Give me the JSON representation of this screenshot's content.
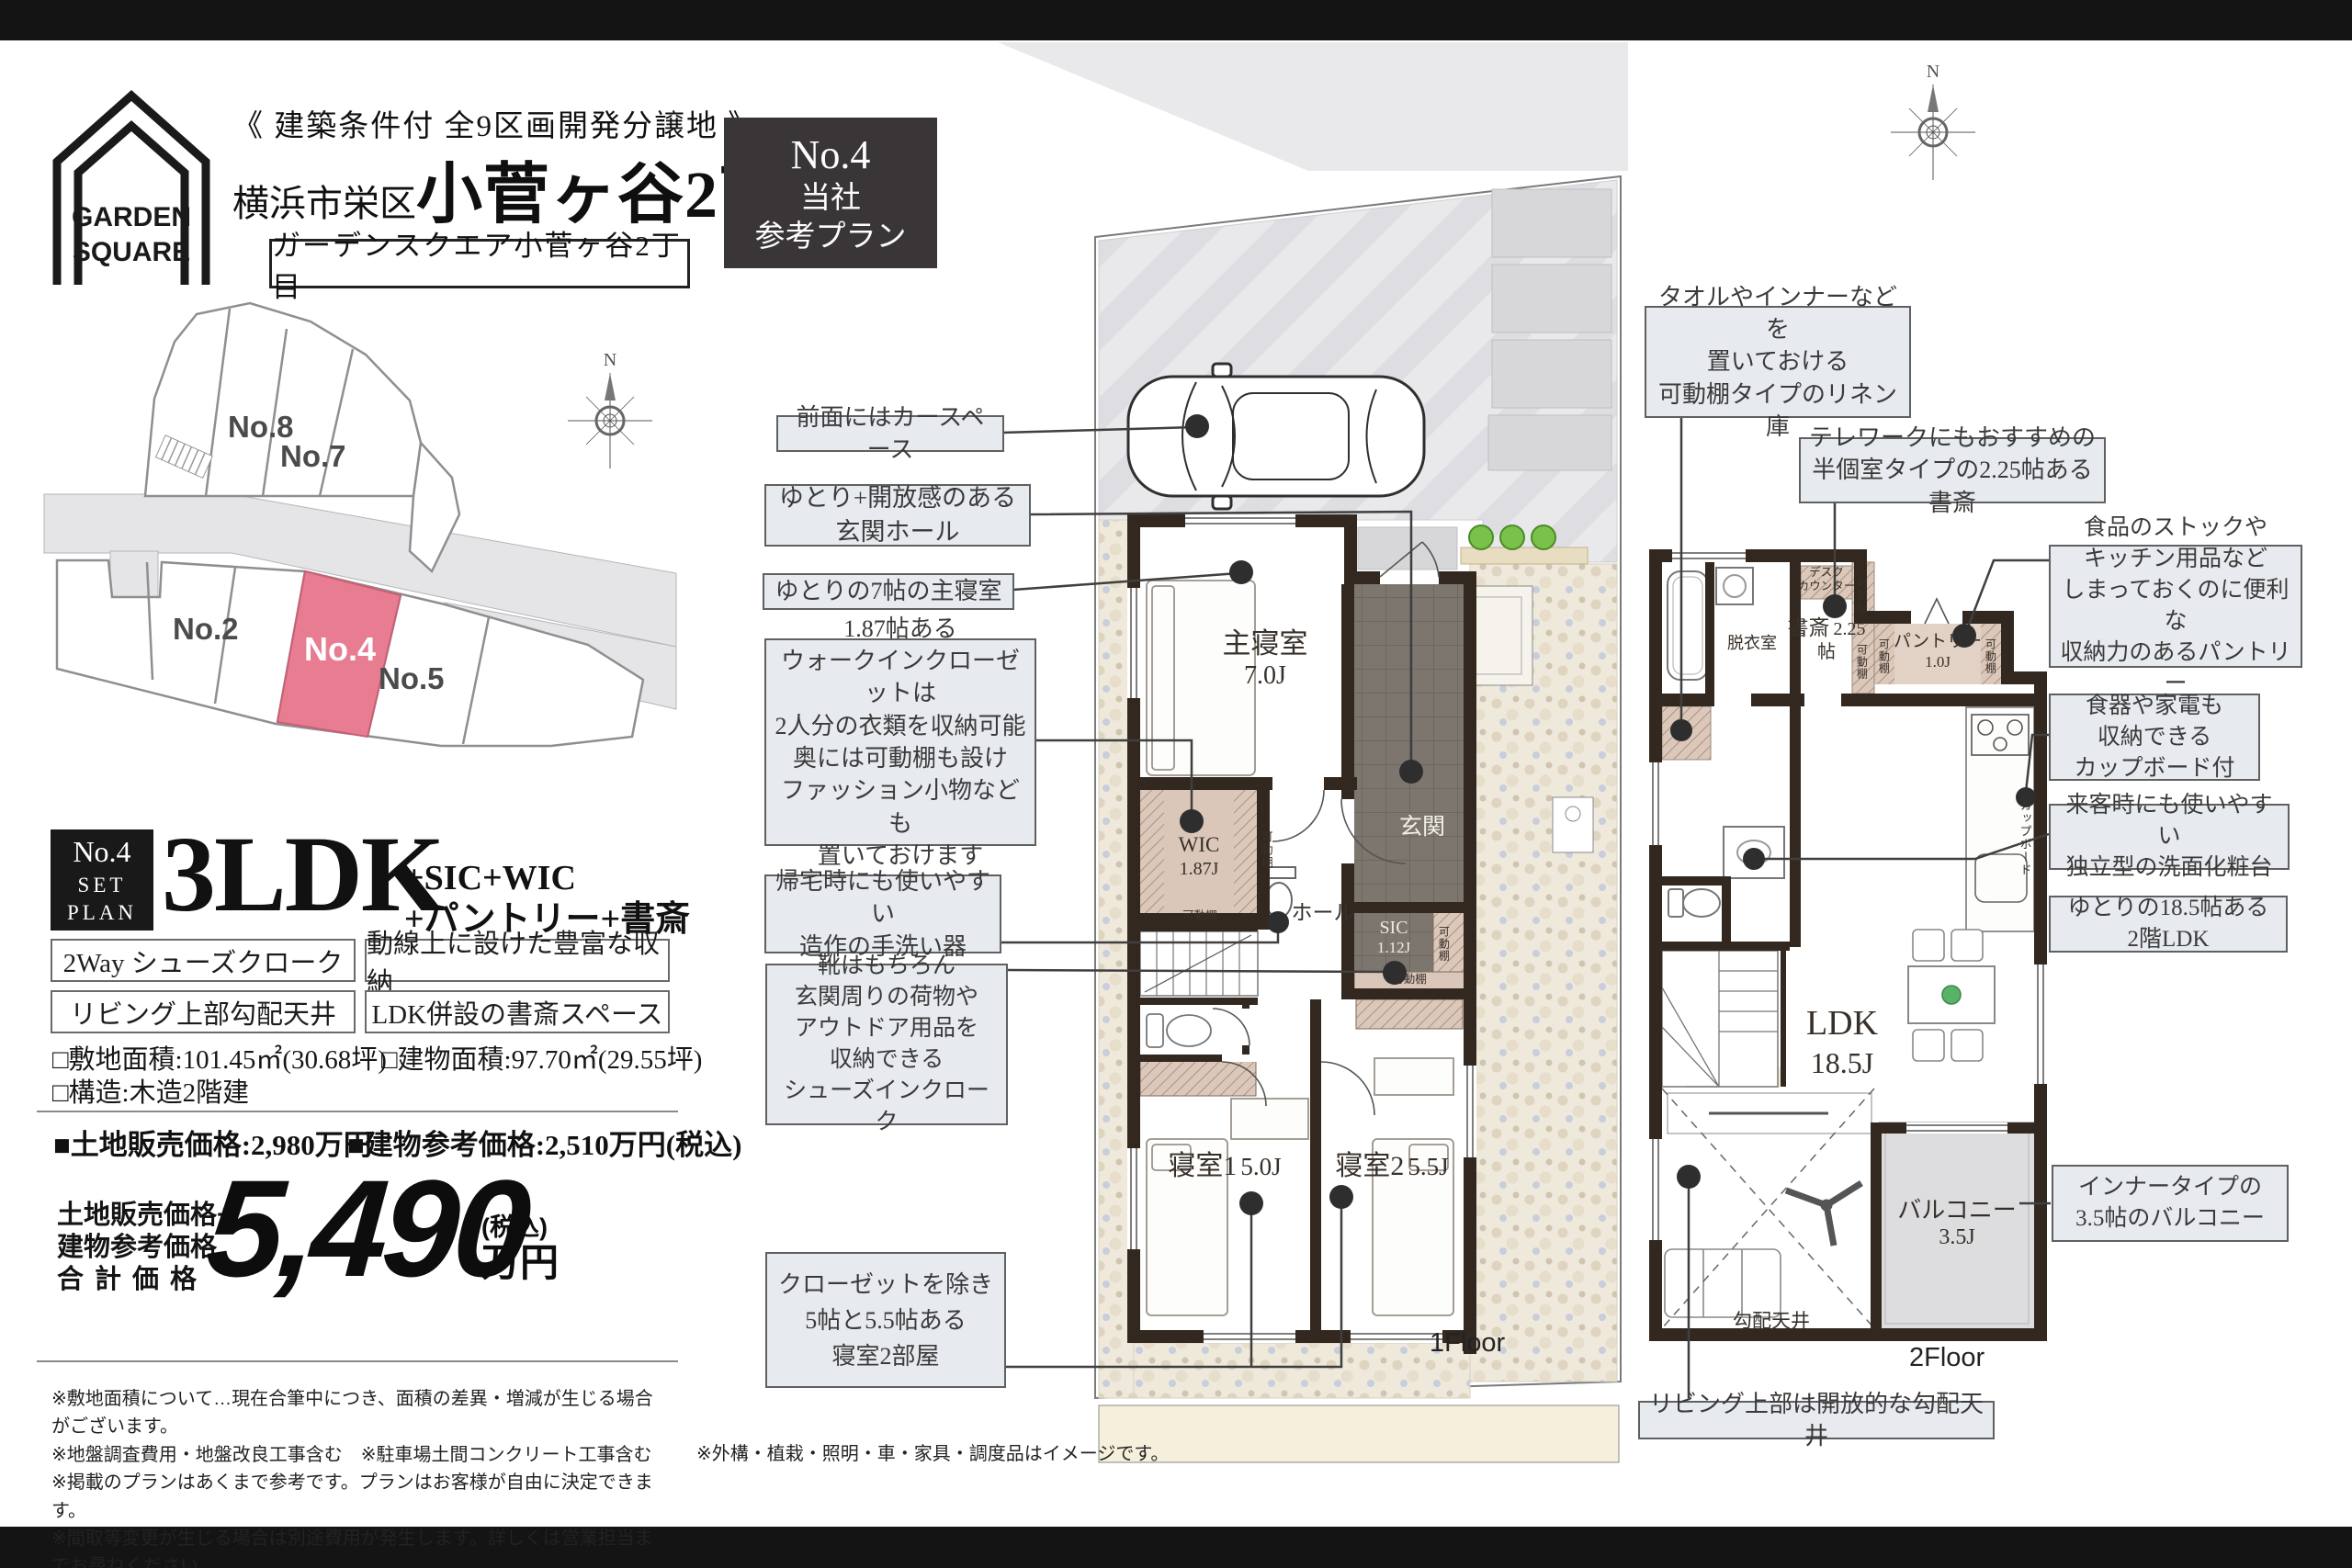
{
  "header": {
    "logo": {
      "line1": "GARDEN",
      "line2": "SQUARE"
    },
    "condition": "《 建築条件付 全9区画開発分譲地 》",
    "city": "横浜市栄区",
    "town": "小菅ヶ谷2丁目",
    "project": "ガーデンスクエア小菅ヶ谷2丁目",
    "badge": {
      "no": "No.4",
      "org": "当社",
      "plan": "参考プラン"
    }
  },
  "site_map": {
    "compass": "N",
    "highlight_color": "#e87d92",
    "lots": {
      "no8": "No.8",
      "no7": "No.7",
      "no2": "No.2",
      "no4": "No.4",
      "no5": "No.5"
    }
  },
  "summary": {
    "badge": {
      "no": "No.4",
      "set": "SET",
      "plan": "PLAN"
    },
    "ldk": "3LDK",
    "extras1": "+SIC+WIC",
    "extras2": "+パントリー+書斎",
    "features": [
      "2Way シューズクローク",
      "動線上に設けた豊富な収納",
      "リビング上部勾配天井",
      "LDK併設の書斎スペース"
    ],
    "site_area": "□敷地面積:101.45㎡(30.68坪)",
    "building_area": "□建物面積:97.70㎡(29.55坪)",
    "structure": "□構造:木造2階建",
    "land_price": "■土地販売価格:2,980万円",
    "building_price": "■建物参考価格:2,510万円(税込)",
    "total": {
      "label1": "土地販売価格+",
      "label2": "建物参考価格",
      "label3": "合計価格",
      "price": "5,490",
      "tax": "(税込)",
      "unit": "万円"
    }
  },
  "callouts": {
    "left": [
      {
        "lines": [
          "前面にはカースペース"
        ]
      },
      {
        "lines": [
          "ゆとり+開放感のある",
          "玄関ホール"
        ]
      },
      {
        "lines": [
          "ゆとりの7帖の主寝室"
        ]
      },
      {
        "lines": [
          "1.87帖ある",
          "ウォークインクローゼットは",
          "2人分の衣類を収納可能",
          "奥には可動棚も設け",
          "ファッション小物なども",
          "置いておけます"
        ]
      },
      {
        "lines": [
          "帰宅時にも使いやすい",
          "造作の手洗い器"
        ]
      },
      {
        "lines": [
          "靴はもちろん",
          "玄関周りの荷物や",
          "アウトドア用品を",
          "収納できる",
          "シューズインクローク"
        ]
      },
      {
        "lines": [
          "クローゼットを除き",
          "5帖と5.5帖ある",
          "寝室2部屋"
        ]
      }
    ],
    "right": [
      {
        "lines": [
          "タオルやインナーなどを",
          "置いておける",
          "可動棚タイプのリネン庫"
        ]
      },
      {
        "lines": [
          "テレワークにもおすすめの",
          "半個室タイプの2.25帖ある書斎"
        ]
      },
      {
        "lines": [
          "食品のストックや",
          "キッチン用品など",
          "しまっておくのに便利な",
          "収納力のあるパントリー"
        ]
      },
      {
        "lines": [
          "食器や家電も",
          "収納できる",
          "カップボード付"
        ]
      },
      {
        "lines": [
          "来客時にも使いやすい",
          "独立型の洗面化粧台"
        ]
      },
      {
        "lines": [
          "ゆとりの18.5帖ある",
          "2階LDK"
        ]
      },
      {
        "lines": [
          "インナータイプの",
          "3.5帖のバルコニー"
        ]
      },
      {
        "lines": [
          "リビング上部は開放的な勾配天井"
        ]
      }
    ]
  },
  "floor1": {
    "label": "1Floor",
    "master": {
      "name": "主寝室",
      "size": "7.0J"
    },
    "wic": {
      "name": "WIC",
      "size": "1.87J"
    },
    "hall": "ホール",
    "genkan": "玄関",
    "sic": {
      "name": "SIC",
      "size": "1.12J"
    },
    "bed1": {
      "name": "寝室1",
      "size": "5.0J"
    },
    "bed2": {
      "name": "寝室2",
      "size": "5.5J"
    },
    "shelf": "可動棚"
  },
  "floor2": {
    "label": "2Floor",
    "desk": [
      "デスク",
      "カウンター"
    ],
    "study": {
      "name": "書斎",
      "size": "2.25帖"
    },
    "pantry": {
      "name": "パントリー",
      "size": "1.0J"
    },
    "dressing": "脱衣室",
    "cupboard": "カップボード",
    "ldk": {
      "name": "LDK",
      "size": "18.5J"
    },
    "balcony": {
      "name": "バルコニー",
      "size": "3.5J"
    },
    "sloped": "勾配天井",
    "shelf": "可動棚"
  },
  "notes": {
    "lines": [
      "※敷地面積について…現在合筆中につき、面積の差異・増減が生じる場合がございます。",
      "※地盤調査費用・地盤改良工事含む　※駐車場土間コンクリート工事含む",
      "※掲載のプランはあくまで参考です。プランはお客様が自由に決定できます。",
      "※間取等変更が生じる場合は別途費用が発生します。詳しくは営業担当までお尋ねください。"
    ],
    "right": "※外構・植栽・照明・車・家具・調度品はイメージです。"
  }
}
